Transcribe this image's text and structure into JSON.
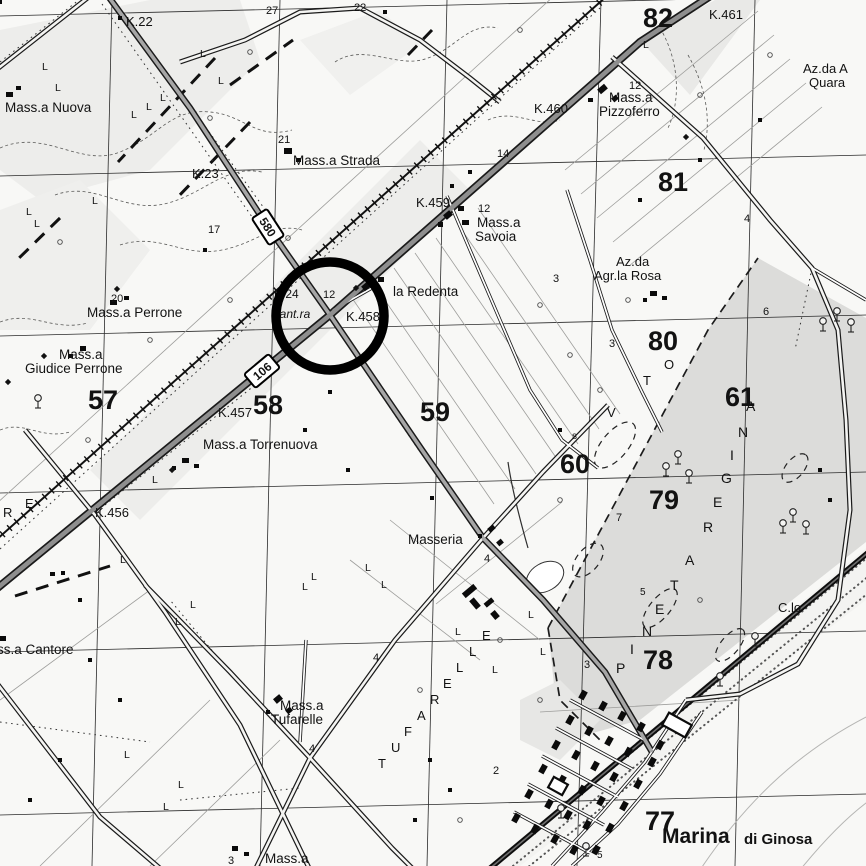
{
  "map": {
    "ink": "#121212",
    "background": "#f8f8f6",
    "annotation_circle": {
      "x": 330,
      "y": 316,
      "r": 54,
      "stroke_width": 9.5,
      "color": "#000000"
    },
    "road_badges": [
      {
        "text": "580",
        "x": 268,
        "y": 227,
        "rot": 57
      },
      {
        "text": "106",
        "x": 262,
        "y": 371,
        "rot": -40
      }
    ],
    "labels": [
      {
        "t": "K.22",
        "x": 126,
        "y": 26,
        "s": 13,
        "n": "km-marker-k22"
      },
      {
        "t": "27",
        "x": 266,
        "y": 14,
        "s": 11
      },
      {
        "t": "22",
        "x": 354,
        "y": 11,
        "s": 11
      },
      {
        "t": "Mass.a Nuova",
        "x": 5,
        "y": 112,
        "s": 13.5,
        "n": "label-massa-nuova"
      },
      {
        "t": "21",
        "x": 278,
        "y": 143,
        "s": 11
      },
      {
        "t": "Mass.a Strada",
        "x": 293,
        "y": 165,
        "s": 13.5,
        "n": "label-massa-strada"
      },
      {
        "t": "K.23",
        "x": 192,
        "y": 178,
        "s": 13,
        "n": "km-marker-k23"
      },
      {
        "t": "17",
        "x": 208,
        "y": 233,
        "s": 11
      },
      {
        "t": "82",
        "x": 643,
        "y": 27,
        "s": 27,
        "b": 1,
        "n": "grid-number-82"
      },
      {
        "t": "K.461",
        "x": 709,
        "y": 19,
        "s": 13,
        "n": "km-marker-k461"
      },
      {
        "t": "Az.da A",
        "x": 803,
        "y": 73,
        "s": 13,
        "n": "label-azienda-quaranta"
      },
      {
        "t": "Quara",
        "x": 809,
        "y": 87,
        "s": 13
      },
      {
        "t": "12",
        "x": 629,
        "y": 89,
        "s": 11
      },
      {
        "t": "Mass.a",
        "x": 609,
        "y": 102,
        "s": 13.5,
        "n": "label-massa-pizzoferro"
      },
      {
        "t": "Pizzoferro",
        "x": 599,
        "y": 116,
        "s": 13.5
      },
      {
        "t": "K.460",
        "x": 534,
        "y": 113,
        "s": 13,
        "n": "km-marker-k460"
      },
      {
        "t": "14",
        "x": 497,
        "y": 157,
        "s": 11
      },
      {
        "t": "81",
        "x": 658,
        "y": 191,
        "s": 27,
        "b": 1,
        "n": "grid-number-81"
      },
      {
        "t": "K.459",
        "x": 416,
        "y": 207,
        "s": 13,
        "n": "km-marker-k459"
      },
      {
        "t": "12",
        "x": 478,
        "y": 212,
        "s": 11
      },
      {
        "t": "Mass.a",
        "x": 477,
        "y": 227,
        "s": 13.5,
        "n": "label-massa-savoia"
      },
      {
        "t": "Savoia",
        "x": 475,
        "y": 241,
        "s": 13.5
      },
      {
        "t": "Az.da",
        "x": 616,
        "y": 266,
        "s": 13,
        "n": "label-azienda-rosa"
      },
      {
        "t": "Agr.la Rosa",
        "x": 594,
        "y": 280,
        "s": 13
      },
      {
        "t": "3",
        "x": 553,
        "y": 282,
        "s": 11
      },
      {
        "t": "4",
        "x": 744,
        "y": 222,
        "s": 11
      },
      {
        "t": "la Redenta",
        "x": 393,
        "y": 296,
        "s": 13.5,
        "n": "label-la-redenta"
      },
      {
        "t": "K.24",
        "x": 274,
        "y": 298,
        "s": 12
      },
      {
        "t": "12",
        "x": 323,
        "y": 298,
        "s": 11
      },
      {
        "t": "Cant.ra",
        "x": 271,
        "y": 318,
        "s": 12,
        "i": 1,
        "n": "label-cantoniera"
      },
      {
        "t": "K.458",
        "x": 346,
        "y": 321,
        "s": 13,
        "n": "km-marker-k458"
      },
      {
        "t": "20",
        "x": 111,
        "y": 302,
        "s": 11
      },
      {
        "t": "Mass.a Perrone",
        "x": 87,
        "y": 317,
        "s": 13.5,
        "n": "label-massa-perrone"
      },
      {
        "t": "Mass.a",
        "x": 59,
        "y": 359,
        "s": 13.5,
        "n": "label-massa-giudice-perrone"
      },
      {
        "t": "Giudice Perrone",
        "x": 25,
        "y": 373,
        "s": 13.5
      },
      {
        "t": "57",
        "x": 88,
        "y": 409,
        "s": 27,
        "b": 1,
        "n": "grid-number-57"
      },
      {
        "t": "58",
        "x": 253,
        "y": 414,
        "s": 27,
        "b": 1,
        "n": "grid-number-58"
      },
      {
        "t": "59",
        "x": 420,
        "y": 421,
        "s": 27,
        "b": 1,
        "n": "grid-number-59"
      },
      {
        "t": "K.457",
        "x": 218,
        "y": 417,
        "s": 13,
        "n": "km-marker-k457"
      },
      {
        "t": "Mass.a Torrenuova",
        "x": 203,
        "y": 449,
        "s": 13.5,
        "n": "label-massa-torrenuova"
      },
      {
        "t": "80",
        "x": 648,
        "y": 350,
        "s": 27,
        "b": 1,
        "n": "grid-number-80"
      },
      {
        "t": "s",
        "x": 572,
        "y": 439,
        "s": 10
      },
      {
        "t": "60",
        "x": 560,
        "y": 473,
        "s": 27,
        "b": 1,
        "n": "grid-number-60"
      },
      {
        "t": "61",
        "x": 725,
        "y": 406,
        "s": 27,
        "b": 1,
        "n": "grid-number-61"
      },
      {
        "t": "6",
        "x": 763,
        "y": 315,
        "s": 11
      },
      {
        "t": "3",
        "x": 609,
        "y": 347,
        "s": 11
      },
      {
        "t": "79",
        "x": 649,
        "y": 509,
        "s": 27,
        "b": 1,
        "n": "grid-number-79"
      },
      {
        "t": "7",
        "x": 616,
        "y": 521,
        "s": 11
      },
      {
        "t": "K.456",
        "x": 95,
        "y": 517,
        "s": 13,
        "n": "km-marker-k456"
      },
      {
        "t": "R",
        "x": 3,
        "y": 517,
        "s": 13
      },
      {
        "t": "E",
        "x": 25,
        "y": 508,
        "s": 13
      },
      {
        "t": "ss.a Cantore",
        "x": -3,
        "y": 654,
        "s": 13.5,
        "n": "label-massa-cantore"
      },
      {
        "t": "Masseria",
        "x": 408,
        "y": 544,
        "s": 13.5,
        "n": "label-masseria"
      },
      {
        "t": "4",
        "x": 484,
        "y": 562,
        "s": 11
      },
      {
        "t": "4",
        "x": 373,
        "y": 661,
        "s": 11
      },
      {
        "t": "Mass.a",
        "x": 280,
        "y": 710,
        "s": 13.5,
        "n": "label-massa-tufarelle"
      },
      {
        "t": "Tufarelle",
        "x": 271,
        "y": 724,
        "s": 13.5
      },
      {
        "t": "4",
        "x": 309,
        "y": 752,
        "s": 11
      },
      {
        "t": "2",
        "x": 493,
        "y": 774,
        "s": 11
      },
      {
        "t": "78",
        "x": 643,
        "y": 669,
        "s": 27,
        "b": 1,
        "n": "grid-number-78"
      },
      {
        "t": "C.lo",
        "x": 778,
        "y": 612,
        "s": 13,
        "n": "label-casello"
      },
      {
        "t": "5",
        "x": 640,
        "y": 595,
        "s": 10
      },
      {
        "t": "3",
        "x": 584,
        "y": 668,
        "s": 11
      },
      {
        "t": "77",
        "x": 645,
        "y": 830,
        "s": 27,
        "b": 1,
        "n": "grid-number-77"
      },
      {
        "t": "Marina",
        "x": 662,
        "y": 843,
        "s": 21,
        "b": 1,
        "n": "label-marina-di-ginosa"
      },
      {
        "t": "di Ginosa",
        "x": 744,
        "y": 844,
        "s": 15,
        "b": 1
      },
      {
        "t": "5",
        "x": 597,
        "y": 858,
        "s": 10
      },
      {
        "t": "3",
        "x": 228,
        "y": 864,
        "s": 11
      },
      {
        "t": "Mass.a",
        "x": 265,
        "y": 863,
        "s": 13.5
      }
    ],
    "letter_labels": [
      {
        "n": "label-tufarelle-contrada",
        "s": 13,
        "chars": [
          [
            "T",
            378,
            768
          ],
          [
            "U",
            391,
            752
          ],
          [
            "F",
            404,
            736
          ],
          [
            "A",
            417,
            720
          ],
          [
            "R",
            430,
            704
          ],
          [
            "E",
            443,
            688
          ],
          [
            "L",
            456,
            672
          ],
          [
            "L",
            469,
            656
          ],
          [
            "E",
            482,
            640
          ]
        ]
      },
      {
        "n": "label-pineta-regina",
        "s": 14,
        "chars": [
          [
            "P",
            616,
            673
          ],
          [
            "I",
            630,
            654
          ],
          [
            "N",
            642,
            636
          ],
          [
            "E",
            655,
            614
          ],
          [
            "T",
            670,
            590
          ],
          [
            "A",
            685,
            565
          ],
          [
            "R",
            703,
            532
          ],
          [
            "E",
            713,
            507
          ],
          [
            "G",
            721,
            483
          ],
          [
            "I",
            730,
            460
          ],
          [
            "N",
            738,
            437
          ],
          [
            "A",
            746,
            411
          ]
        ]
      },
      {
        "n": "label-vto",
        "s": 13,
        "chars": [
          [
            "V",
            607,
            417
          ],
          [
            "T",
            643,
            385
          ],
          [
            "O",
            664,
            369
          ]
        ]
      }
    ],
    "l_marks": [
      [
        200,
        57
      ],
      [
        218,
        84
      ],
      [
        42,
        70
      ],
      [
        55,
        91
      ],
      [
        131,
        118
      ],
      [
        146,
        110
      ],
      [
        160,
        101
      ],
      [
        92,
        204
      ],
      [
        26,
        215
      ],
      [
        34,
        227
      ],
      [
        643,
        48
      ],
      [
        120,
        563
      ],
      [
        190,
        608
      ],
      [
        175,
        625
      ],
      [
        124,
        758
      ],
      [
        178,
        788
      ],
      [
        163,
        810
      ],
      [
        311,
        580
      ],
      [
        302,
        590
      ],
      [
        365,
        571
      ],
      [
        381,
        588
      ],
      [
        455,
        635
      ],
      [
        492,
        673
      ],
      [
        152,
        483
      ],
      [
        528,
        618
      ],
      [
        540,
        655
      ]
    ],
    "small_circles": [
      [
        250,
        52
      ],
      [
        210,
        118
      ],
      [
        288,
        238
      ],
      [
        520,
        30
      ],
      [
        700,
        95
      ],
      [
        540,
        305
      ],
      [
        570,
        355
      ],
      [
        600,
        390
      ],
      [
        628,
        300
      ],
      [
        560,
        500
      ],
      [
        700,
        600
      ],
      [
        420,
        690
      ],
      [
        500,
        640
      ],
      [
        540,
        700
      ],
      [
        460,
        820
      ],
      [
        230,
        300
      ],
      [
        60,
        242
      ],
      [
        150,
        340
      ],
      [
        88,
        440
      ],
      [
        770,
        55
      ]
    ],
    "diamonds": [
      [
        117,
        289
      ],
      [
        44,
        356
      ],
      [
        686,
        137
      ],
      [
        172,
        470
      ],
      [
        356,
        288
      ],
      [
        8,
        382
      ]
    ],
    "farm_dots": [
      [
        385,
        12
      ],
      [
        120,
        18
      ],
      [
        205,
        250
      ],
      [
        305,
        430
      ],
      [
        348,
        470
      ],
      [
        432,
        498
      ],
      [
        560,
        430
      ],
      [
        640,
        200
      ],
      [
        700,
        160
      ],
      [
        760,
        120
      ],
      [
        820,
        470
      ],
      [
        830,
        500
      ],
      [
        90,
        660
      ],
      [
        120,
        700
      ],
      [
        60,
        760
      ],
      [
        30,
        800
      ],
      [
        430,
        760
      ],
      [
        450,
        790
      ],
      [
        415,
        820
      ],
      [
        0,
        2
      ],
      [
        63,
        573
      ],
      [
        330,
        392
      ],
      [
        452,
        186
      ],
      [
        470,
        172
      ]
    ],
    "buildings": [
      [
        6,
        92,
        7,
        5,
        0
      ],
      [
        16,
        86,
        5,
        4,
        0
      ],
      [
        284,
        148,
        8,
        6,
        0
      ],
      [
        296,
        158,
        5,
        4,
        0
      ],
      [
        598,
        86,
        9,
        6,
        -40
      ],
      [
        612,
        96,
        6,
        5,
        -40
      ],
      [
        588,
        98,
        5,
        4,
        0
      ],
      [
        444,
        212,
        8,
        6,
        -40
      ],
      [
        458,
        206,
        6,
        5,
        0
      ],
      [
        438,
        222,
        5,
        5,
        0
      ],
      [
        462,
        220,
        7,
        5,
        0
      ],
      [
        362,
        283,
        9,
        6,
        -40
      ],
      [
        378,
        277,
        6,
        5,
        0
      ],
      [
        650,
        291,
        7,
        5,
        0
      ],
      [
        662,
        296,
        5,
        4,
        0
      ],
      [
        643,
        298,
        4,
        4,
        0
      ],
      [
        110,
        300,
        7,
        5,
        0
      ],
      [
        124,
        296,
        5,
        4,
        0
      ],
      [
        80,
        346,
        6,
        5,
        0
      ],
      [
        68,
        354,
        5,
        4,
        0
      ],
      [
        182,
        458,
        7,
        5,
        0
      ],
      [
        194,
        464,
        5,
        4,
        0
      ],
      [
        172,
        466,
        4,
        4,
        0
      ],
      [
        50,
        572,
        5,
        4,
        0
      ],
      [
        78,
        598,
        4,
        4,
        0
      ],
      [
        0,
        636,
        6,
        5,
        0
      ],
      [
        488,
        526,
        7,
        5,
        -40
      ],
      [
        497,
        540,
        6,
        5,
        -40
      ],
      [
        478,
        534,
        4,
        4,
        0
      ],
      [
        462,
        588,
        15,
        6,
        -40
      ],
      [
        472,
        598,
        6,
        11,
        -40
      ],
      [
        484,
        600,
        10,
        5,
        -40
      ],
      [
        492,
        611,
        6,
        8,
        -40
      ],
      [
        274,
        696,
        8,
        6,
        -40
      ],
      [
        286,
        708,
        6,
        5,
        -40
      ],
      [
        266,
        710,
        4,
        4,
        0
      ],
      [
        232,
        846,
        6,
        5,
        0
      ],
      [
        244,
        852,
        5,
        4,
        0
      ]
    ],
    "town": {
      "rot": -61,
      "w": 9,
      "h": 6,
      "positions": [
        [
          583,
          695
        ],
        [
          603,
          706
        ],
        [
          622,
          716
        ],
        [
          641,
          727
        ],
        [
          570,
          720
        ],
        [
          589,
          731
        ],
        [
          609,
          741
        ],
        [
          628,
          752
        ],
        [
          556,
          745
        ],
        [
          576,
          755
        ],
        [
          595,
          766
        ],
        [
          614,
          777
        ],
        [
          543,
          769
        ],
        [
          562,
          780
        ],
        [
          582,
          790
        ],
        [
          601,
          801
        ],
        [
          529,
          794
        ],
        [
          549,
          804
        ],
        [
          568,
          815
        ],
        [
          587,
          825
        ],
        [
          516,
          818
        ],
        [
          535,
          829
        ],
        [
          555,
          839
        ],
        [
          574,
          850
        ],
        [
          652,
          762
        ],
        [
          638,
          784
        ],
        [
          624,
          806
        ],
        [
          610,
          828
        ],
        [
          596,
          850
        ],
        [
          660,
          745
        ]
      ]
    },
    "outlined_buildings": [
      [
        664,
        718,
        26,
        14,
        29
      ],
      [
        550,
        780,
        16,
        12,
        29
      ]
    ],
    "trees": [
      [
        823,
        325
      ],
      [
        837,
        315
      ],
      [
        851,
        326
      ],
      [
        678,
        458
      ],
      [
        666,
        470
      ],
      [
        689,
        477
      ],
      [
        793,
        516
      ],
      [
        783,
        527
      ],
      [
        806,
        528
      ],
      [
        755,
        640
      ],
      [
        720,
        680
      ],
      [
        561,
        812
      ],
      [
        586,
        850
      ],
      [
        38,
        402
      ]
    ]
  }
}
